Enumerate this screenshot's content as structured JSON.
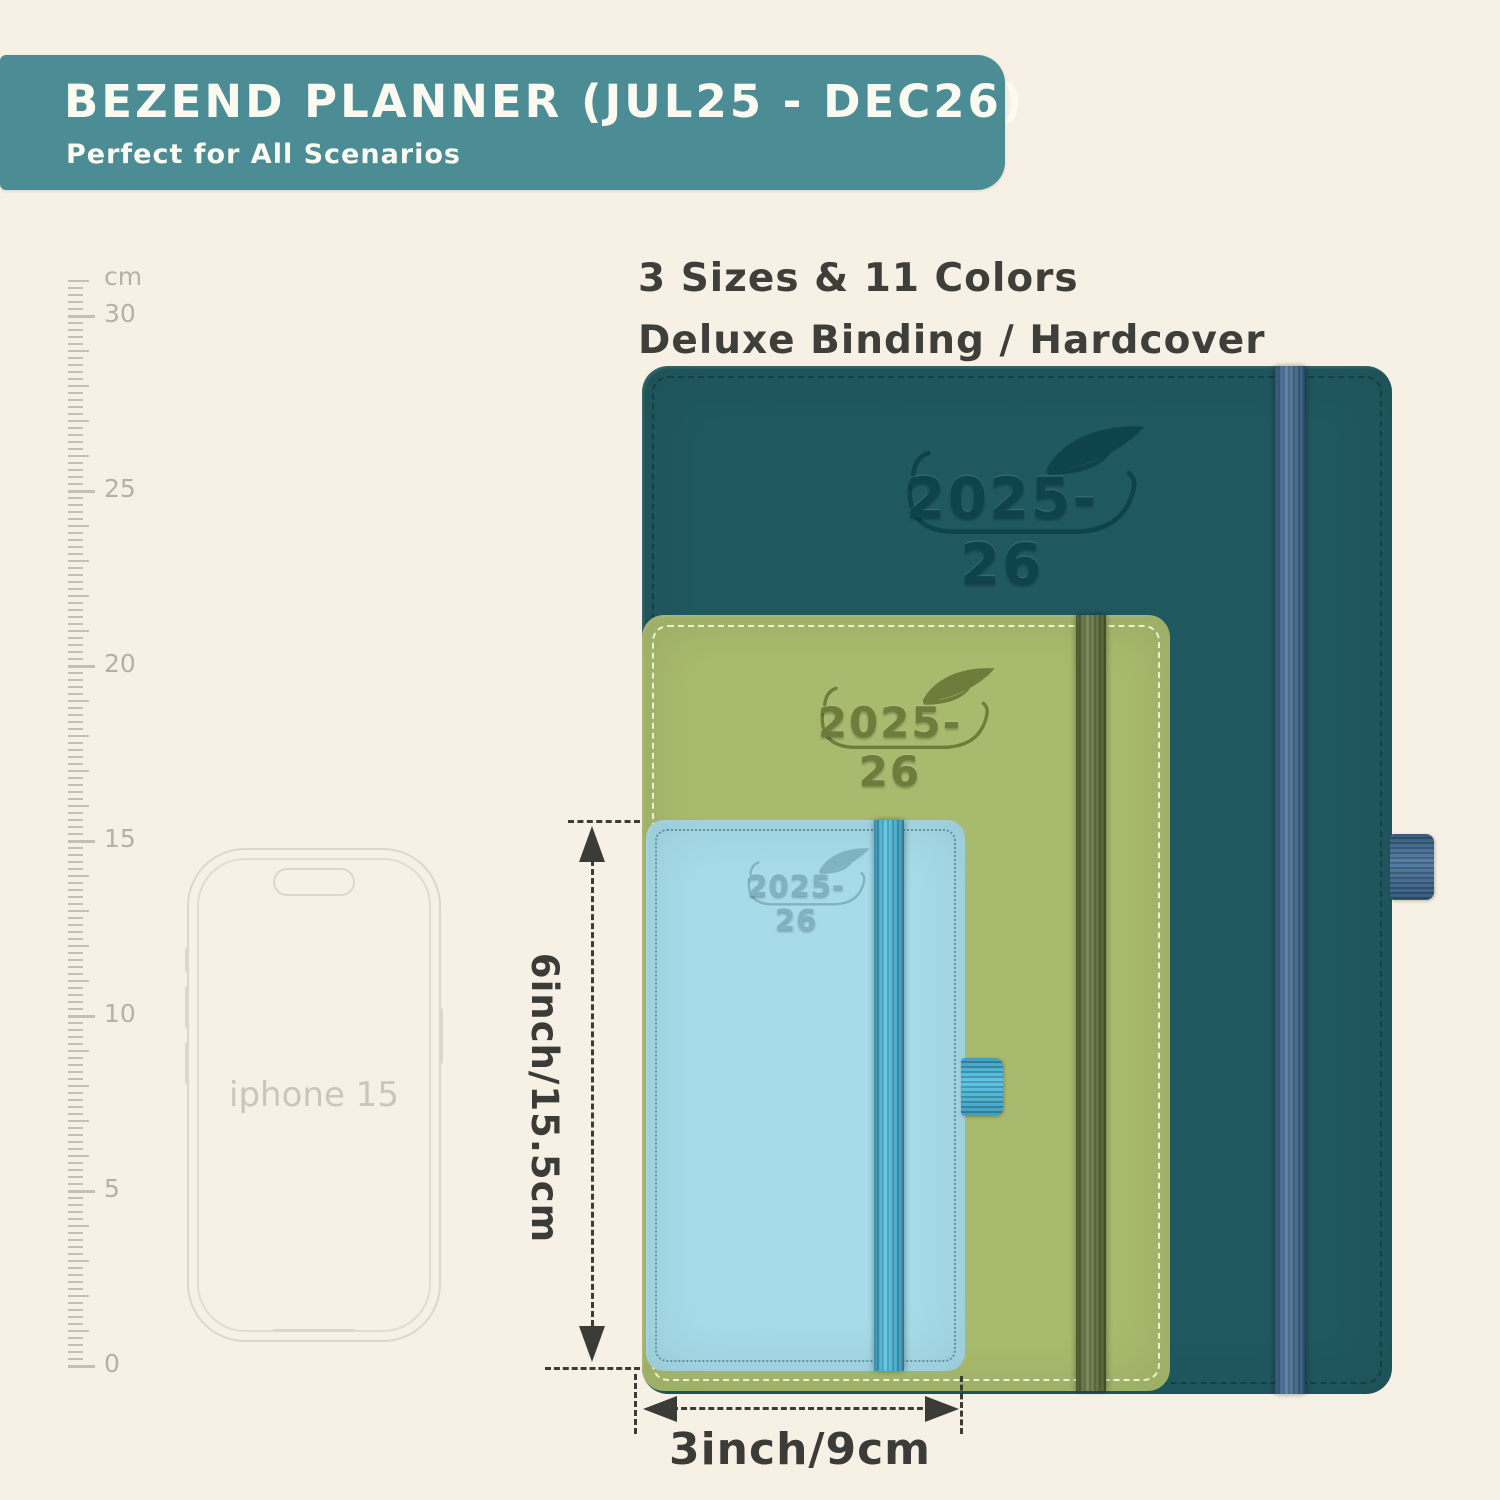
{
  "banner": {
    "title": "BEZEND PLANNER (JUL25 - DEC26)",
    "subtitle": "Perfect for All Scenarios",
    "bg_color": "#4b8c95",
    "text_color": "#fbfaf1"
  },
  "headline": {
    "line1": "3 Sizes & 11 Colors",
    "line2": "Deluxe Binding / Hardcover",
    "text_color": "#3e3e3a"
  },
  "ruler": {
    "unit_label": "cm",
    "marks": [
      {
        "cm": 30,
        "label": "30"
      },
      {
        "cm": 25,
        "label": "25"
      },
      {
        "cm": 20,
        "label": "20"
      },
      {
        "cm": 15,
        "label": "15"
      },
      {
        "cm": 10,
        "label": "10"
      },
      {
        "cm": 5,
        "label": "5"
      },
      {
        "cm": 0,
        "label": "0"
      }
    ],
    "max_cm": 31,
    "tick_color": "#c6c0b3",
    "label_color": "#b7b1a4"
  },
  "phone": {
    "label": "iphone 15",
    "outline_color": "#ddd7c9"
  },
  "planners": [
    {
      "id": "large",
      "size_rank": "largest",
      "year_label": "2025-26",
      "cover_color": "#20585f",
      "emboss_color": "#0e434c",
      "elastic_color": "#44719c",
      "stitch_color": "rgba(8,48,54,0.55)"
    },
    {
      "id": "medium",
      "size_rank": "middle",
      "year_label": "2025-26",
      "cover_color": "#a8ba6d",
      "emboss_color": "#6f7d3c",
      "elastic_color": "#68793f",
      "stitch_color": "rgba(250,252,228,0.85)"
    },
    {
      "id": "small",
      "size_rank": "smallest",
      "year_label": "2025-26",
      "cover_color": "#a7dbe9",
      "emboss_color": "#7fb3c3",
      "elastic_color": "#4cc2e8",
      "stitch_color": "rgba(42,96,112,0.55)"
    }
  ],
  "dimensions": {
    "height_label": "6inch/15.5cm",
    "width_label": "3inch/9cm",
    "line_color": "#3b3b38"
  }
}
